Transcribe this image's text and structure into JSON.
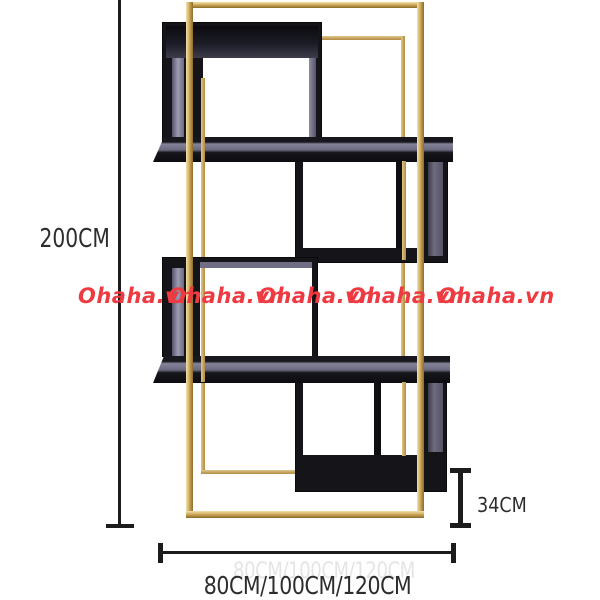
{
  "image_type": "product-dimension-diagram",
  "watermark": {
    "text": "Ohaha.vn",
    "count": 5,
    "color": "#ee3a40"
  },
  "dimensions": {
    "height_label": "200CM",
    "width_label": "80CM/100CM/120CM",
    "depth_label": "34CM"
  },
  "shelf": {
    "frame_color_name": "gold",
    "frame_color": "#d2ac5e",
    "box_color_name": "black",
    "box_color": "#141419",
    "box_count": 4
  },
  "annotation_color": "#2d2d2d"
}
